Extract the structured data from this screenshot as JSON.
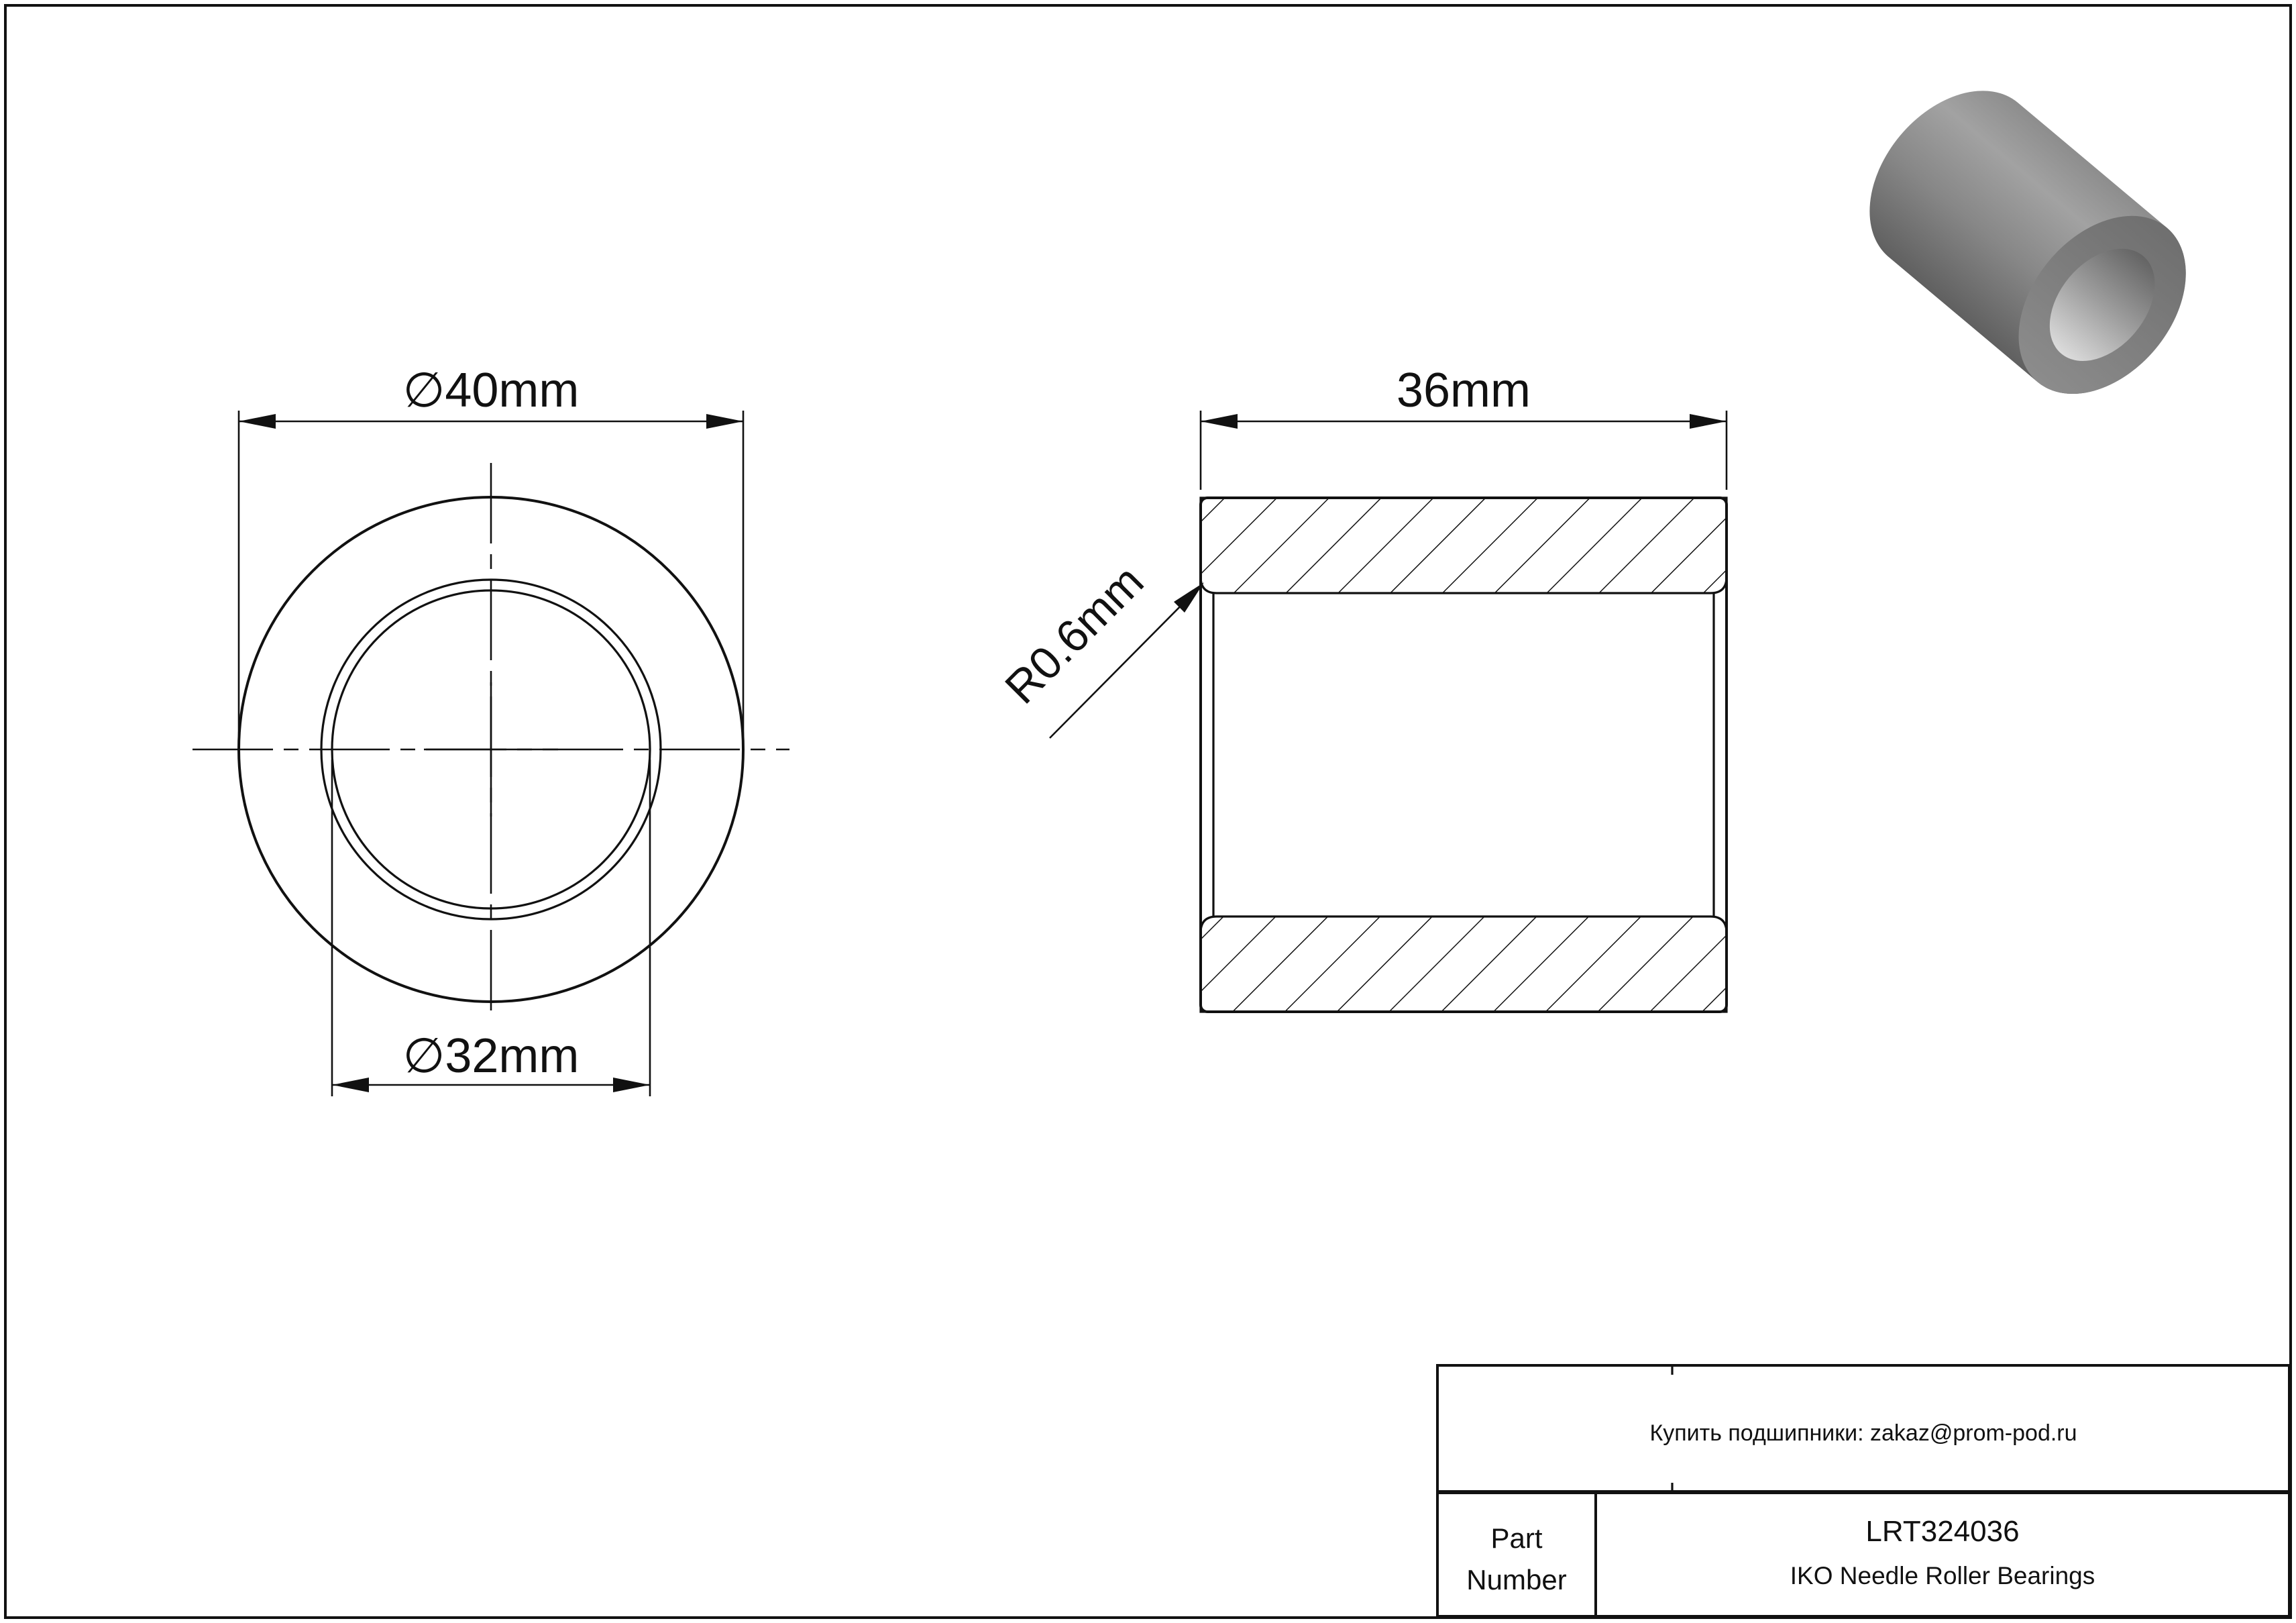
{
  "drawing": {
    "front_view": {
      "outer_diameter_label": "∅40mm",
      "bore_diameter_label": "∅32mm"
    },
    "section_view": {
      "width_label": "36mm",
      "fillet_radius_label": "R0.6mm"
    },
    "dimensions": {
      "outer_diameter_mm": 40,
      "bore_diameter_mm": 32,
      "width_mm": 36,
      "fillet_radius_mm": 0.6
    }
  },
  "title_block": {
    "contact_line": "Купить подшипники: zakaz@prom-pod.ru",
    "part_label_line1": "Part",
    "part_label_line2": "Number",
    "part_number": "LRT324036",
    "product_line": "IKO Needle Roller Bearings"
  },
  "colors": {
    "line": "#111111",
    "background": "#ffffff",
    "render_body_gray": "#8a8a8a",
    "render_face_gray": "#787878",
    "render_bore_light": "#d6d6d6"
  }
}
